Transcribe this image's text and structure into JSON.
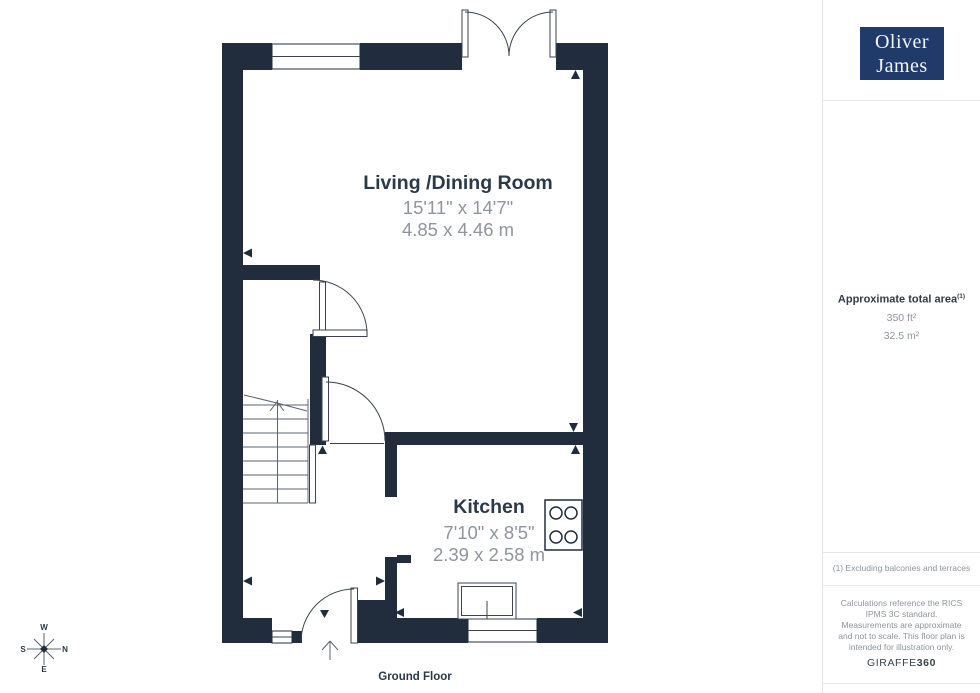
{
  "logo": {
    "line1": "Oliver",
    "line2": "James"
  },
  "sidebar": {
    "area_heading": "Approximate total area",
    "area_heading_sup": "(1)",
    "area_ft": "350 ft²",
    "area_m": "32.5 m²",
    "footnote": "(1) Excluding balconies and terraces",
    "disclaimer": "Calculations reference the RICS IPMS 3C standard. Measurements are approximate and not to scale. This floor plan is intended for illustration only.",
    "brand": "GIRAFFE",
    "brand_bold": "360"
  },
  "plan": {
    "floor_label": "Ground Floor",
    "rooms": [
      {
        "name": "Living /Dining Room",
        "dims_imperial": "15'11\" x 14'7\"",
        "dims_metric": "4.85 x 4.46 m"
      },
      {
        "name": "Kitchen",
        "dims_imperial": "7'10\" x 8'5\"",
        "dims_metric": "2.39 x 2.58 m"
      }
    ],
    "compass": {
      "top": "W",
      "right": "N",
      "bottom": "E",
      "left": "S"
    }
  },
  "colors": {
    "wall": "#212d3d",
    "logo_bg": "#203a69",
    "label": "#2b3a49",
    "dims": "#8e959d"
  }
}
